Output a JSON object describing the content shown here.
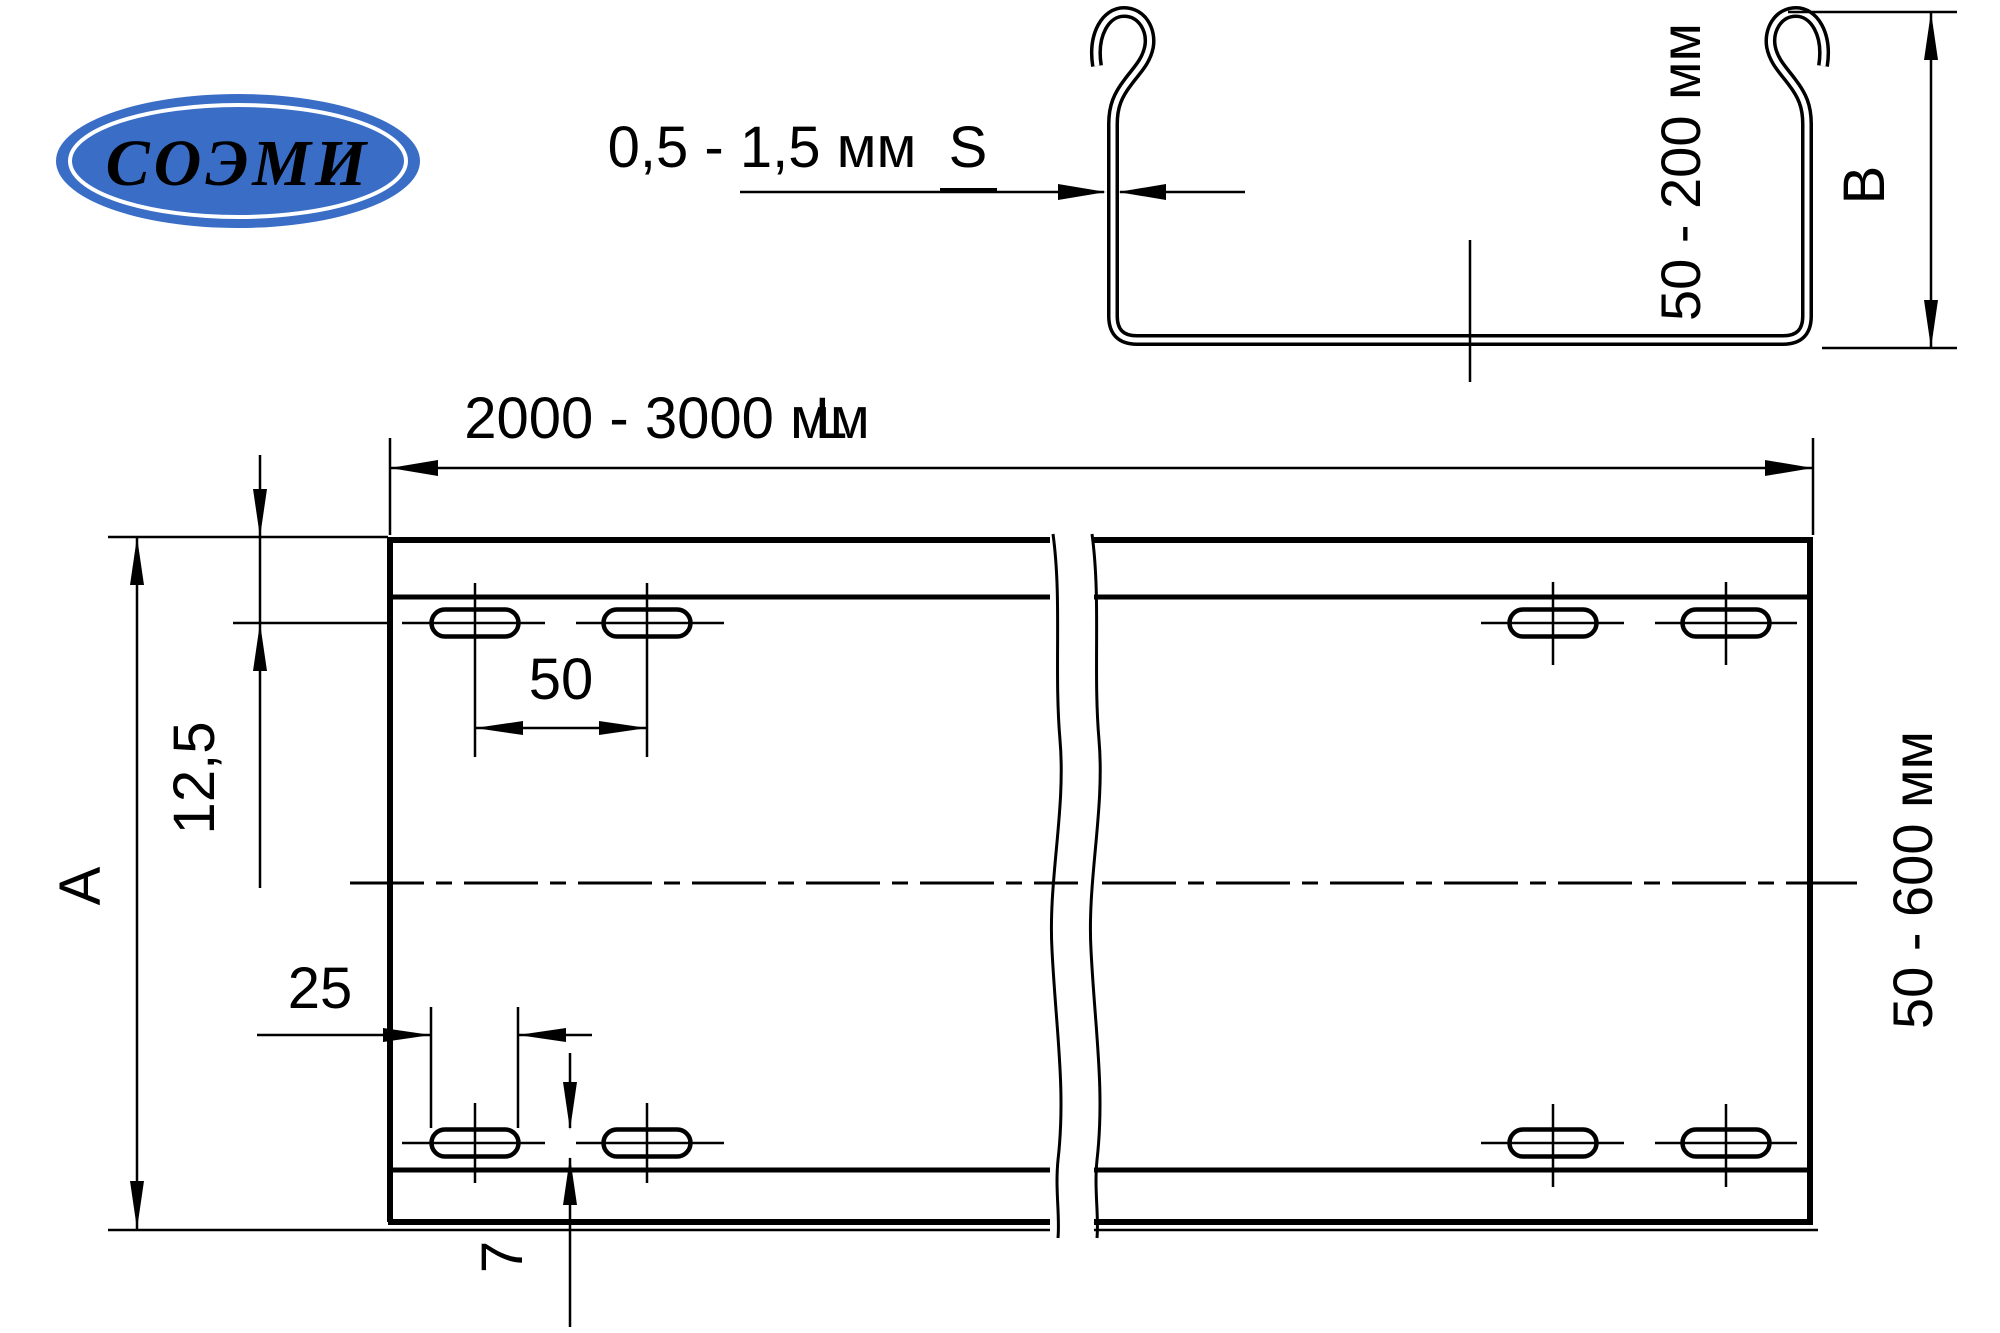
{
  "logo": {
    "text": "СОЭМИ",
    "ellipse_color": "#3a6ec6",
    "text_color": "#ffffff"
  },
  "section_view": {
    "thickness_range": "0,5 - 1,5 мм",
    "thickness_symbol": "S",
    "height_range": "50 - 200 мм",
    "height_symbol": "B"
  },
  "plan_view": {
    "length_range": "2000 - 3000 мм",
    "length_symbol": "L",
    "width_range": "50 - 600 мм",
    "width_symbol": "A",
    "hole_row_edge_offset": "12,5",
    "hole_spacing": "50",
    "hole_length": "25",
    "hole_width": "7"
  }
}
